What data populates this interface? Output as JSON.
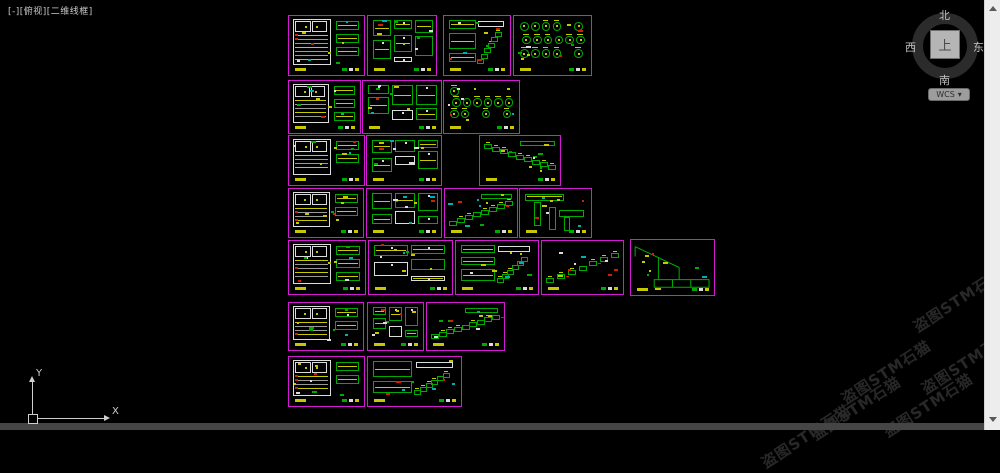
{
  "viewport": {
    "label": "[-][俯视][二维线框]"
  },
  "viewcube": {
    "north": "北",
    "south": "南",
    "west": "西",
    "east": "东",
    "top": "上",
    "wcs_label": "WCS",
    "wcs_arrow": "▾"
  },
  "ucs": {
    "x_label": "X",
    "y_label": "Y"
  },
  "watermark": {
    "text": "盗图STM石猫",
    "positions": [
      {
        "x": 958,
        "y": 300
      },
      {
        "x": 966,
        "y": 362
      },
      {
        "x": 886,
        "y": 372
      },
      {
        "x": 856,
        "y": 408
      },
      {
        "x": 928,
        "y": 405
      },
      {
        "x": 806,
        "y": 436
      }
    ]
  },
  "colors": {
    "frame": "#d418d4",
    "yellow": "#c8c800",
    "green": "#00ab00",
    "white": "#dcdcdc",
    "red": "#cc2200",
    "cyan": "#00b0b0",
    "magenta": "#d418d4",
    "gray": "#9a9a9a"
  },
  "frames": [
    {
      "id": "f1",
      "x": 288,
      "y": 15,
      "w": 77,
      "h": 61,
      "kind": "table"
    },
    {
      "id": "f2",
      "x": 367,
      "y": 15,
      "w": 70,
      "h": 61,
      "kind": "blocks"
    },
    {
      "id": "f3",
      "x": 443,
      "y": 15,
      "w": 68,
      "h": 61,
      "kind": "mixed"
    },
    {
      "id": "f4",
      "x": 513,
      "y": 15,
      "w": 79,
      "h": 61,
      "kind": "circles"
    },
    {
      "id": "f5",
      "x": 288,
      "y": 80,
      "w": 73,
      "h": 54,
      "kind": "table"
    },
    {
      "id": "f6",
      "x": 362,
      "y": 80,
      "w": 80,
      "h": 54,
      "kind": "blocks"
    },
    {
      "id": "f7",
      "x": 443,
      "y": 80,
      "w": 77,
      "h": 54,
      "kind": "circles"
    },
    {
      "id": "f8",
      "x": 288,
      "y": 135,
      "w": 77,
      "h": 51,
      "kind": "table"
    },
    {
      "id": "f9",
      "x": 366,
      "y": 135,
      "w": 76,
      "h": 51,
      "kind": "blocks"
    },
    {
      "id": "f10",
      "x": 479,
      "y": 135,
      "w": 82,
      "h": 51,
      "kind": "stairs"
    },
    {
      "id": "f11",
      "x": 288,
      "y": 188,
      "w": 76,
      "h": 50,
      "kind": "table"
    },
    {
      "id": "f12",
      "x": 366,
      "y": 188,
      "w": 76,
      "h": 50,
      "kind": "blocks"
    },
    {
      "id": "f13",
      "x": 444,
      "y": 188,
      "w": 74,
      "h": 50,
      "kind": "stairs"
    },
    {
      "id": "f14",
      "x": 519,
      "y": 188,
      "w": 73,
      "h": 50,
      "kind": "pipes"
    },
    {
      "id": "f15",
      "x": 288,
      "y": 240,
      "w": 78,
      "h": 55,
      "kind": "table"
    },
    {
      "id": "f16",
      "x": 368,
      "y": 240,
      "w": 85,
      "h": 55,
      "kind": "blocks"
    },
    {
      "id": "f17",
      "x": 455,
      "y": 240,
      "w": 84,
      "h": 55,
      "kind": "mixed"
    },
    {
      "id": "f18",
      "x": 541,
      "y": 240,
      "w": 83,
      "h": 55,
      "kind": "stairs"
    },
    {
      "id": "f19",
      "x": 630,
      "y": 239,
      "w": 85,
      "h": 57,
      "kind": "roof"
    },
    {
      "id": "f20",
      "x": 288,
      "y": 302,
      "w": 76,
      "h": 49,
      "kind": "table"
    },
    {
      "id": "f21",
      "x": 367,
      "y": 302,
      "w": 57,
      "h": 49,
      "kind": "blocks"
    },
    {
      "id": "f22",
      "x": 426,
      "y": 302,
      "w": 79,
      "h": 49,
      "kind": "stairs"
    },
    {
      "id": "f23",
      "x": 288,
      "y": 356,
      "w": 77,
      "h": 51,
      "kind": "table"
    },
    {
      "id": "f24",
      "x": 367,
      "y": 356,
      "w": 95,
      "h": 51,
      "kind": "mixed"
    }
  ]
}
